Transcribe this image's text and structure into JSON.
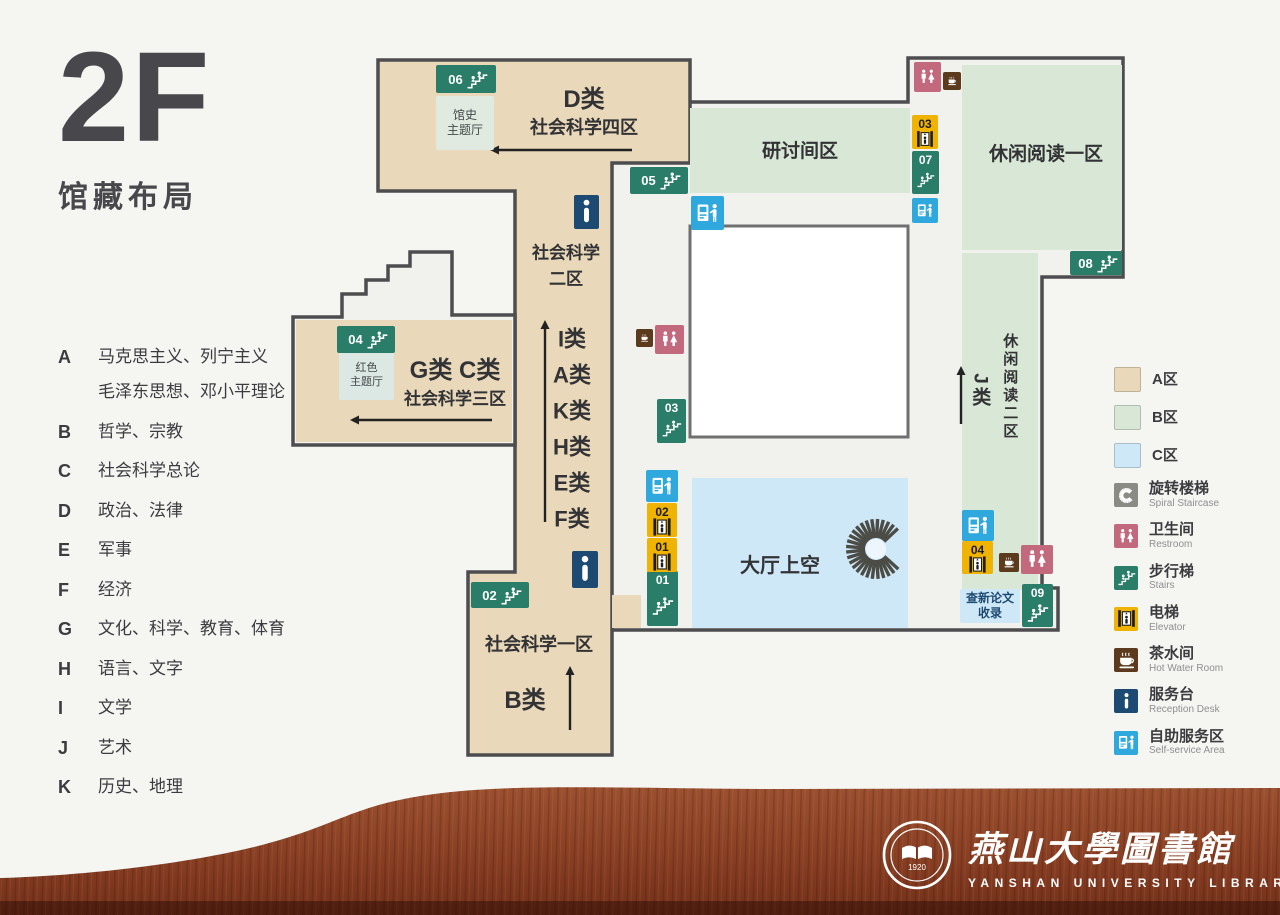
{
  "header": {
    "floor": "2F",
    "subtitle": "馆藏布局"
  },
  "categories": [
    {
      "letter": "A",
      "text": "马克思主义、列宁主义",
      "text2": "毛泽东思想、邓小平理论"
    },
    {
      "letter": "B",
      "text": "哲学、宗教"
    },
    {
      "letter": "C",
      "text": "社会科学总论"
    },
    {
      "letter": "D",
      "text": "政治、法律"
    },
    {
      "letter": "E",
      "text": "军事"
    },
    {
      "letter": "F",
      "text": "经济"
    },
    {
      "letter": "G",
      "text": "文化、科学、教育、体育"
    },
    {
      "letter": "H",
      "text": "语言、文字"
    },
    {
      "letter": "I",
      "text": "文学"
    },
    {
      "letter": "J",
      "text": "艺术"
    },
    {
      "letter": "K",
      "text": "历史、地理"
    }
  ],
  "palette": {
    "zone_a": "#e9d9ba",
    "zone_b": "#d8e7d6",
    "zone_c": "#cfe8f8",
    "stairs": "#2a7d68",
    "elevator": "#f0b400",
    "restroom": "#c2697e",
    "hotwater": "#5b3a1d",
    "reception": "#1d4a72",
    "selfservice": "#2fa8dd",
    "spiral": "#8b8b86",
    "wall": "#4d4d4f",
    "interior": "#f1f1ee",
    "wood": "#8a4527"
  },
  "map": {
    "labels": [
      {
        "text": "D类",
        "x": 584,
        "y": 100,
        "fs": 24,
        "w": "bold"
      },
      {
        "text": "社会科学四区",
        "x": 584,
        "y": 128,
        "fs": 18,
        "w": "600"
      },
      {
        "text": "研讨间区",
        "x": 800,
        "y": 152,
        "fs": 19,
        "w": "600"
      },
      {
        "text": "休闲阅读一区",
        "x": 1046,
        "y": 155,
        "fs": 19,
        "w": "600"
      },
      {
        "text": "社会科学\n二区",
        "x": 566,
        "y": 266,
        "fs": 17,
        "w": "600"
      },
      {
        "text": "I类",
        "x": 572,
        "y": 339,
        "fs": 22,
        "w": "bold"
      },
      {
        "text": "A类",
        "x": 572,
        "y": 375,
        "fs": 22,
        "w": "bold"
      },
      {
        "text": "K类",
        "x": 572,
        "y": 411,
        "fs": 22,
        "w": "bold"
      },
      {
        "text": "H类",
        "x": 572,
        "y": 447,
        "fs": 22,
        "w": "bold"
      },
      {
        "text": "E类",
        "x": 572,
        "y": 483,
        "fs": 22,
        "w": "bold"
      },
      {
        "text": "F类",
        "x": 572,
        "y": 519,
        "fs": 22,
        "w": "bold"
      },
      {
        "text": "G类 C类",
        "x": 455,
        "y": 371,
        "fs": 24,
        "w": "bold"
      },
      {
        "text": "社会科学三区",
        "x": 455,
        "y": 399,
        "fs": 17,
        "w": "600"
      },
      {
        "text": "社会科学一区",
        "x": 539,
        "y": 645,
        "fs": 18,
        "w": "600"
      },
      {
        "text": "B类",
        "x": 525,
        "y": 701,
        "fs": 24,
        "w": "bold"
      },
      {
        "text": "大厅上空",
        "x": 780,
        "y": 566,
        "fs": 20,
        "w": "600"
      },
      {
        "text": "休闲阅读二区",
        "x": 1009,
        "y": 387,
        "fs": 15,
        "w": "600",
        "vertical": true
      },
      {
        "text": "J类",
        "x": 979,
        "y": 391,
        "fs": 19,
        "w": "bold",
        "vertical": true
      }
    ],
    "rooms": [
      {
        "text": "馆史\n主题厅",
        "x": 436,
        "y": 96,
        "w": 58,
        "h": 54,
        "bg": "#e0eae1",
        "fs": 12
      },
      {
        "text": "红色\n主题厅",
        "x": 339,
        "y": 352,
        "w": 55,
        "h": 48,
        "bg": "#dce8e4",
        "fs": 11
      },
      {
        "text": "查新论文\n收录",
        "x": 960,
        "y": 589,
        "w": 60,
        "h": 34,
        "bg": "#cfe8f8",
        "fs": 12,
        "color": "#1d4a72",
        "bold": true
      }
    ],
    "badges": [
      {
        "type": "stairs",
        "num": "06",
        "x": 436,
        "y": 65,
        "w": 60,
        "h": 28,
        "layout": "h"
      },
      {
        "type": "stairs",
        "num": "05",
        "x": 630,
        "y": 167,
        "w": 58,
        "h": 27,
        "layout": "h"
      },
      {
        "type": "stairs",
        "num": "04",
        "x": 337,
        "y": 326,
        "w": 58,
        "h": 27,
        "layout": "h"
      },
      {
        "type": "stairs",
        "num": "02",
        "x": 471,
        "y": 582,
        "w": 58,
        "h": 26,
        "layout": "h"
      },
      {
        "type": "stairs",
        "num": "08",
        "x": 1070,
        "y": 251,
        "w": 52,
        "h": 24,
        "layout": "h"
      },
      {
        "type": "stairs",
        "num": "07",
        "x": 912,
        "y": 151,
        "w": 27,
        "h": 43,
        "layout": "v"
      },
      {
        "type": "stairs",
        "num": "03",
        "x": 657,
        "y": 399,
        "w": 29,
        "h": 44,
        "layout": "v"
      },
      {
        "type": "stairs",
        "num": "01",
        "x": 647,
        "y": 571,
        "w": 31,
        "h": 55,
        "layout": "v"
      },
      {
        "type": "stairs",
        "num": "09",
        "x": 1022,
        "y": 584,
        "w": 31,
        "h": 43,
        "layout": "v"
      },
      {
        "type": "elevator",
        "num": "03",
        "x": 912,
        "y": 115,
        "w": 26,
        "h": 34,
        "layout": "v"
      },
      {
        "type": "elevator",
        "num": "02",
        "x": 647,
        "y": 503,
        "w": 30,
        "h": 34,
        "layout": "v"
      },
      {
        "type": "elevator",
        "num": "01",
        "x": 647,
        "y": 538,
        "w": 30,
        "h": 34,
        "layout": "v"
      },
      {
        "type": "elevator",
        "num": "04",
        "x": 962,
        "y": 541,
        "w": 31,
        "h": 33,
        "layout": "v"
      },
      {
        "type": "restroom",
        "x": 914,
        "y": 62,
        "w": 27,
        "h": 30
      },
      {
        "type": "hotwater",
        "x": 943,
        "y": 72,
        "w": 18,
        "h": 18
      },
      {
        "type": "hotwater",
        "x": 636,
        "y": 329,
        "w": 17,
        "h": 18
      },
      {
        "type": "restroom",
        "x": 655,
        "y": 325,
        "w": 29,
        "h": 29
      },
      {
        "type": "hotwater",
        "x": 999,
        "y": 553,
        "w": 20,
        "h": 19
      },
      {
        "type": "restroom",
        "x": 1021,
        "y": 545,
        "w": 32,
        "h": 29
      },
      {
        "type": "reception",
        "x": 574,
        "y": 195,
        "w": 25,
        "h": 34
      },
      {
        "type": "reception",
        "x": 572,
        "y": 551,
        "w": 26,
        "h": 37
      },
      {
        "type": "selfservice",
        "x": 691,
        "y": 196,
        "w": 33,
        "h": 34
      },
      {
        "type": "selfservice",
        "x": 912,
        "y": 198,
        "w": 26,
        "h": 25
      },
      {
        "type": "selfservice",
        "x": 646,
        "y": 470,
        "w": 32,
        "h": 32
      },
      {
        "type": "selfservice",
        "x": 962,
        "y": 510,
        "w": 32,
        "h": 31
      }
    ],
    "arrows": [
      {
        "x1": 632,
        "y1": 150,
        "x2": 490,
        "y2": 150
      },
      {
        "x1": 492,
        "y1": 420,
        "x2": 350,
        "y2": 420
      },
      {
        "x1": 545,
        "y1": 522,
        "x2": 545,
        "y2": 320
      },
      {
        "x1": 570,
        "y1": 730,
        "x2": 570,
        "y2": 666
      },
      {
        "x1": 961,
        "y1": 424,
        "x2": 961,
        "y2": 366
      }
    ]
  },
  "legend": {
    "swatches": [
      {
        "label": "A区",
        "color": "#e9d9ba"
      },
      {
        "label": "B区",
        "color": "#d8e7d6"
      },
      {
        "label": "C区",
        "color": "#cfe8f8"
      }
    ],
    "items": [
      {
        "type": "spiral",
        "zh": "旋转楼梯",
        "en": "Spiral Staircase",
        "color": "#8b8b86"
      },
      {
        "type": "restroom",
        "zh": "卫生间",
        "en": "Restroom",
        "color": "#c2697e"
      },
      {
        "type": "stairs",
        "zh": "步行梯",
        "en": "Stairs",
        "color": "#2a7d68"
      },
      {
        "type": "elevator",
        "zh": "电梯",
        "en": "Elevator",
        "color": "#f0b400"
      },
      {
        "type": "hotwater",
        "zh": "茶水间",
        "en": "Hot Water Room",
        "color": "#5b3a1d"
      },
      {
        "type": "reception",
        "zh": "服务台",
        "en": "Reception Desk",
        "color": "#1d4a72"
      },
      {
        "type": "selfservice",
        "zh": "自助服务区",
        "en": "Self-service Area",
        "color": "#2fa8dd"
      }
    ]
  },
  "footer": {
    "seal_year": "1920",
    "title_zh": "燕山大學圖書館",
    "title_en": "YANSHAN UNIVERSITY LIBRARY"
  }
}
